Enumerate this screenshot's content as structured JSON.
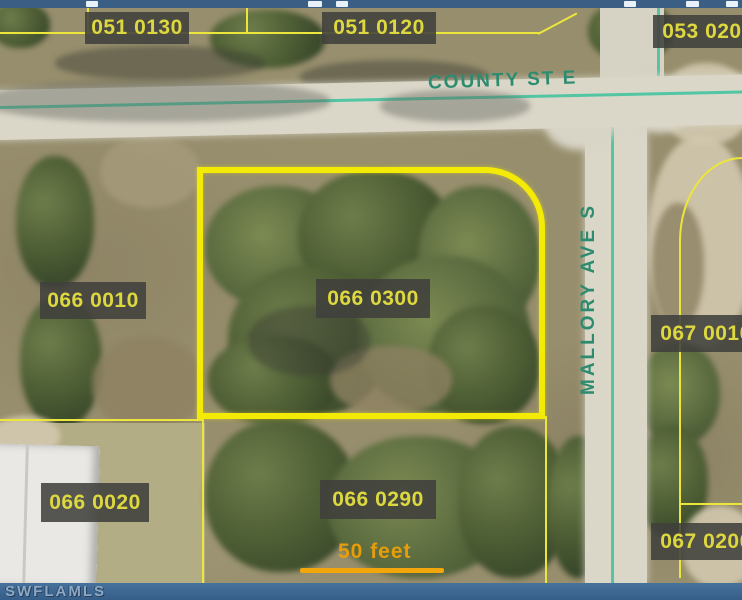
{
  "window": {
    "chrome_strip_color": "#3b5e84",
    "footer": {
      "watermark": "SWFLAMLS",
      "bar_color": "#3a648c"
    }
  },
  "map": {
    "description": "Aerial parcel map with GIS overlay",
    "streets": [
      {
        "name": "COUNTY ST E",
        "orientation": "horizontal"
      },
      {
        "name": "MALLORY AVE S",
        "orientation": "vertical"
      }
    ],
    "parcel_labels": [
      {
        "label": "051 0130"
      },
      {
        "label": "051 0120"
      },
      {
        "label": "053 0200"
      },
      {
        "label": "066 0010"
      },
      {
        "label": "066 0300",
        "highlighted": true
      },
      {
        "label": "067 0010"
      },
      {
        "label": "066 0020"
      },
      {
        "label": "066 0290"
      },
      {
        "label": "067 0200"
      }
    ],
    "highlighted_parcel": "066 0300",
    "scale_bar": {
      "label": "50 feet"
    },
    "colors": {
      "parcel_line": "#ece63c",
      "highlight_line": "#f3eb06",
      "road_centerline": "#52c5a3",
      "label_text": "#ddd83f",
      "label_background": "#44443c",
      "street_text": "#2d8b6f",
      "scale_orange": "#f0a50c"
    }
  }
}
